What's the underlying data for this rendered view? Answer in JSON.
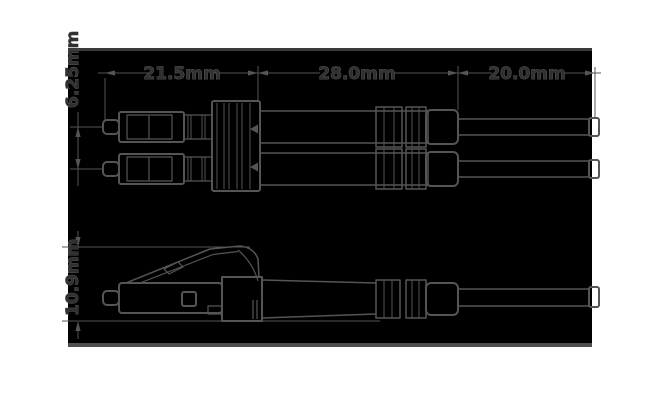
{
  "drawing": {
    "dim_labels": {
      "seg1": "21.5mm",
      "seg2": "28.0mm",
      "seg3": "20.0mm",
      "ferrule_pitch": "6.25mm",
      "height": "10.9mm"
    },
    "colors": {
      "page_bg": "#ffffff",
      "panel_bg": "#000000",
      "panel_top_edge": "#3a3a3a",
      "panel_bottom_edge": "#4f4f4f",
      "line": "#555555",
      "text_fill": "#303030",
      "text_stroke": "#636363"
    }
  }
}
